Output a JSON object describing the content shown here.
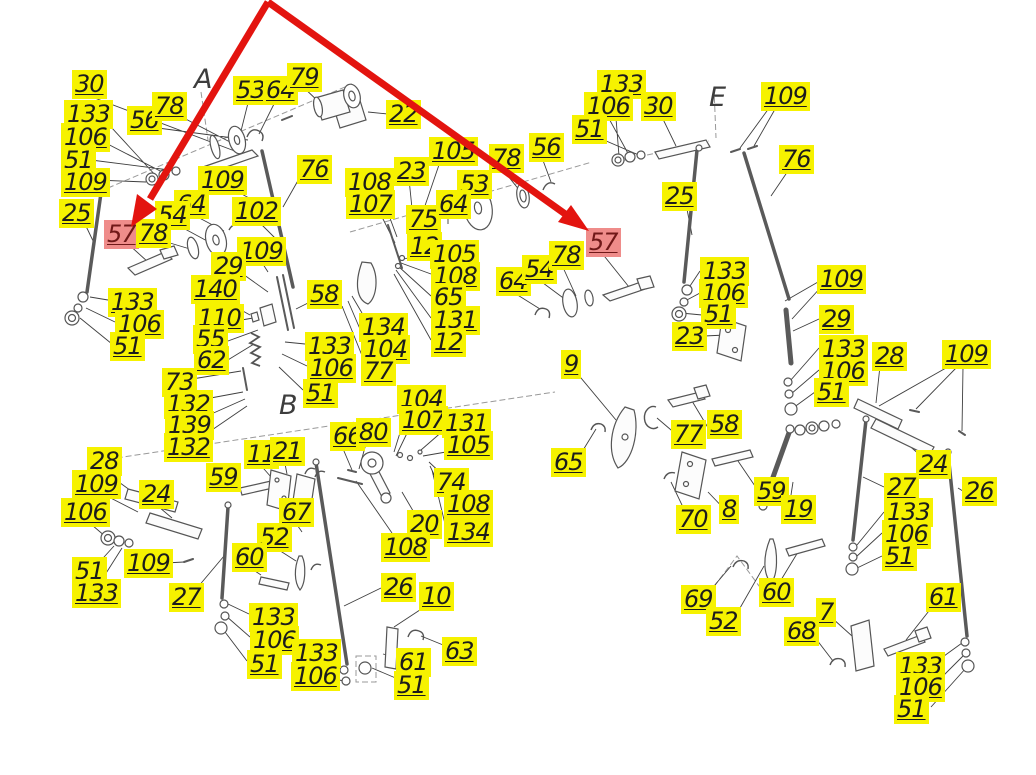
{
  "drawing_type": "exploded-parts-diagram",
  "colors": {
    "background": "#FFFFFF",
    "label_bg": "#F6F200",
    "label_text": "#1C1C1C",
    "highlight_bg": "#EF8C8A",
    "highlight_text": "#701818",
    "arrow_red": "#E3140F",
    "drawing_line": "#555555"
  },
  "callout": {
    "highlighted_part_number": "57",
    "arrow_count": 2,
    "arrow_color": "#E3140F"
  },
  "section_letters": [
    {
      "label": "A",
      "x": 194,
      "y": 66
    },
    {
      "label": "B",
      "x": 279,
      "y": 392
    },
    {
      "label": "E",
      "x": 709,
      "y": 84
    }
  ],
  "labels": [
    {
      "n": "30",
      "x": 72,
      "y": 70
    },
    {
      "n": "133",
      "x": 64,
      "y": 100
    },
    {
      "n": "106",
      "x": 61,
      "y": 123
    },
    {
      "n": "51",
      "x": 61,
      "y": 146
    },
    {
      "n": "109",
      "x": 61,
      "y": 168
    },
    {
      "n": "25",
      "x": 59,
      "y": 199
    },
    {
      "n": "57",
      "x": 104,
      "y": 220,
      "highlighted": true
    },
    {
      "n": "56",
      "x": 127,
      "y": 106
    },
    {
      "n": "78",
      "x": 152,
      "y": 92
    },
    {
      "n": "53",
      "x": 233,
      "y": 76
    },
    {
      "n": "64",
      "x": 263,
      "y": 76
    },
    {
      "n": "79",
      "x": 287,
      "y": 63
    },
    {
      "n": "109",
      "x": 198,
      "y": 166
    },
    {
      "n": "102",
      "x": 232,
      "y": 197
    },
    {
      "n": "76",
      "x": 297,
      "y": 155
    },
    {
      "n": "64",
      "x": 174,
      "y": 190
    },
    {
      "n": "54",
      "x": 155,
      "y": 201
    },
    {
      "n": "78",
      "x": 136,
      "y": 219
    },
    {
      "n": "109",
      "x": 237,
      "y": 237
    },
    {
      "n": "29",
      "x": 211,
      "y": 252
    },
    {
      "n": "140",
      "x": 191,
      "y": 275
    },
    {
      "n": "110",
      "x": 195,
      "y": 304
    },
    {
      "n": "55",
      "x": 193,
      "y": 325
    },
    {
      "n": "62",
      "x": 194,
      "y": 346
    },
    {
      "n": "133",
      "x": 108,
      "y": 288
    },
    {
      "n": "106",
      "x": 115,
      "y": 310
    },
    {
      "n": "51",
      "x": 110,
      "y": 332
    },
    {
      "n": "73",
      "x": 162,
      "y": 368
    },
    {
      "n": "132",
      "x": 164,
      "y": 390
    },
    {
      "n": "139",
      "x": 165,
      "y": 411
    },
    {
      "n": "132",
      "x": 164,
      "y": 433
    },
    {
      "n": "22",
      "x": 386,
      "y": 100
    },
    {
      "n": "108",
      "x": 345,
      "y": 168
    },
    {
      "n": "107",
      "x": 346,
      "y": 190
    },
    {
      "n": "105",
      "x": 429,
      "y": 137
    },
    {
      "n": "23",
      "x": 394,
      "y": 157
    },
    {
      "n": "53",
      "x": 457,
      "y": 170
    },
    {
      "n": "78",
      "x": 489,
      "y": 144
    },
    {
      "n": "56",
      "x": 529,
      "y": 133
    },
    {
      "n": "75",
      "x": 406,
      "y": 205
    },
    {
      "n": "64",
      "x": 436,
      "y": 190
    },
    {
      "n": "12",
      "x": 407,
      "y": 232
    },
    {
      "n": "105",
      "x": 430,
      "y": 240
    },
    {
      "n": "108",
      "x": 431,
      "y": 262
    },
    {
      "n": "65",
      "x": 431,
      "y": 283
    },
    {
      "n": "131",
      "x": 431,
      "y": 306
    },
    {
      "n": "12",
      "x": 431,
      "y": 328
    },
    {
      "n": "64",
      "x": 496,
      "y": 267
    },
    {
      "n": "54",
      "x": 522,
      "y": 255
    },
    {
      "n": "78",
      "x": 549,
      "y": 241
    },
    {
      "n": "57",
      "x": 586,
      "y": 228,
      "highlighted": true
    },
    {
      "n": "58",
      "x": 307,
      "y": 280
    },
    {
      "n": "133",
      "x": 305,
      "y": 332
    },
    {
      "n": "106",
      "x": 307,
      "y": 354
    },
    {
      "n": "51",
      "x": 303,
      "y": 379
    },
    {
      "n": "134",
      "x": 359,
      "y": 313
    },
    {
      "n": "104",
      "x": 361,
      "y": 335
    },
    {
      "n": "77",
      "x": 361,
      "y": 357
    },
    {
      "n": "66",
      "x": 330,
      "y": 422
    },
    {
      "n": "80",
      "x": 356,
      "y": 418
    },
    {
      "n": "104",
      "x": 397,
      "y": 385
    },
    {
      "n": "107",
      "x": 399,
      "y": 406
    },
    {
      "n": "131",
      "x": 442,
      "y": 409
    },
    {
      "n": "105",
      "x": 444,
      "y": 431
    },
    {
      "n": "74",
      "x": 434,
      "y": 468
    },
    {
      "n": "108",
      "x": 444,
      "y": 490
    },
    {
      "n": "20",
      "x": 407,
      "y": 510
    },
    {
      "n": "134",
      "x": 444,
      "y": 518
    },
    {
      "n": "108",
      "x": 381,
      "y": 533
    },
    {
      "n": "28",
      "x": 87,
      "y": 447
    },
    {
      "n": "109",
      "x": 72,
      "y": 470
    },
    {
      "n": "106",
      "x": 61,
      "y": 498
    },
    {
      "n": "51",
      "x": 72,
      "y": 557
    },
    {
      "n": "133",
      "x": 72,
      "y": 579
    },
    {
      "n": "24",
      "x": 139,
      "y": 480
    },
    {
      "n": "109",
      "x": 124,
      "y": 549
    },
    {
      "n": "27",
      "x": 169,
      "y": 583
    },
    {
      "n": "59",
      "x": 206,
      "y": 463
    },
    {
      "n": "11",
      "x": 244,
      "y": 440
    },
    {
      "n": "21",
      "x": 270,
      "y": 437
    },
    {
      "n": "67",
      "x": 279,
      "y": 498
    },
    {
      "n": "52",
      "x": 257,
      "y": 523
    },
    {
      "n": "60",
      "x": 232,
      "y": 543
    },
    {
      "n": "133",
      "x": 249,
      "y": 603
    },
    {
      "n": "106",
      "x": 250,
      "y": 626
    },
    {
      "n": "51",
      "x": 247,
      "y": 650
    },
    {
      "n": "133",
      "x": 292,
      "y": 639
    },
    {
      "n": "106",
      "x": 291,
      "y": 662
    },
    {
      "n": "26",
      "x": 381,
      "y": 573
    },
    {
      "n": "10",
      "x": 419,
      "y": 582
    },
    {
      "n": "61",
      "x": 396,
      "y": 648
    },
    {
      "n": "51",
      "x": 394,
      "y": 671
    },
    {
      "n": "63",
      "x": 442,
      "y": 637
    },
    {
      "n": "133",
      "x": 597,
      "y": 70
    },
    {
      "n": "106",
      "x": 584,
      "y": 92
    },
    {
      "n": "51",
      "x": 572,
      "y": 115
    },
    {
      "n": "30",
      "x": 641,
      "y": 92
    },
    {
      "n": "109",
      "x": 761,
      "y": 82
    },
    {
      "n": "76",
      "x": 779,
      "y": 145
    },
    {
      "n": "25",
      "x": 662,
      "y": 182
    },
    {
      "n": "133",
      "x": 700,
      "y": 257
    },
    {
      "n": "106",
      "x": 699,
      "y": 279
    },
    {
      "n": "51",
      "x": 701,
      "y": 300
    },
    {
      "n": "23",
      "x": 672,
      "y": 322
    },
    {
      "n": "109",
      "x": 817,
      "y": 265
    },
    {
      "n": "29",
      "x": 819,
      "y": 305
    },
    {
      "n": "133",
      "x": 819,
      "y": 335
    },
    {
      "n": "106",
      "x": 819,
      "y": 357
    },
    {
      "n": "51",
      "x": 814,
      "y": 378
    },
    {
      "n": "28",
      "x": 872,
      "y": 342
    },
    {
      "n": "109",
      "x": 942,
      "y": 340
    },
    {
      "n": "9",
      "x": 561,
      "y": 350
    },
    {
      "n": "65",
      "x": 551,
      "y": 448
    },
    {
      "n": "77",
      "x": 671,
      "y": 420
    },
    {
      "n": "58",
      "x": 707,
      "y": 410
    },
    {
      "n": "59",
      "x": 754,
      "y": 477
    },
    {
      "n": "19",
      "x": 781,
      "y": 495
    },
    {
      "n": "8",
      "x": 719,
      "y": 495
    },
    {
      "n": "70",
      "x": 676,
      "y": 505
    },
    {
      "n": "69",
      "x": 681,
      "y": 585
    },
    {
      "n": "52",
      "x": 706,
      "y": 607
    },
    {
      "n": "60",
      "x": 759,
      "y": 578
    },
    {
      "n": "68",
      "x": 784,
      "y": 617
    },
    {
      "n": "7",
      "x": 816,
      "y": 598
    },
    {
      "n": "24",
      "x": 916,
      "y": 450
    },
    {
      "n": "27",
      "x": 884,
      "y": 473
    },
    {
      "n": "26",
      "x": 962,
      "y": 477
    },
    {
      "n": "133",
      "x": 884,
      "y": 498
    },
    {
      "n": "106",
      "x": 882,
      "y": 520
    },
    {
      "n": "51",
      "x": 882,
      "y": 542
    },
    {
      "n": "61",
      "x": 926,
      "y": 583
    },
    {
      "n": "133",
      "x": 896,
      "y": 652
    },
    {
      "n": "106",
      "x": 896,
      "y": 673
    },
    {
      "n": "51",
      "x": 894,
      "y": 695
    }
  ]
}
